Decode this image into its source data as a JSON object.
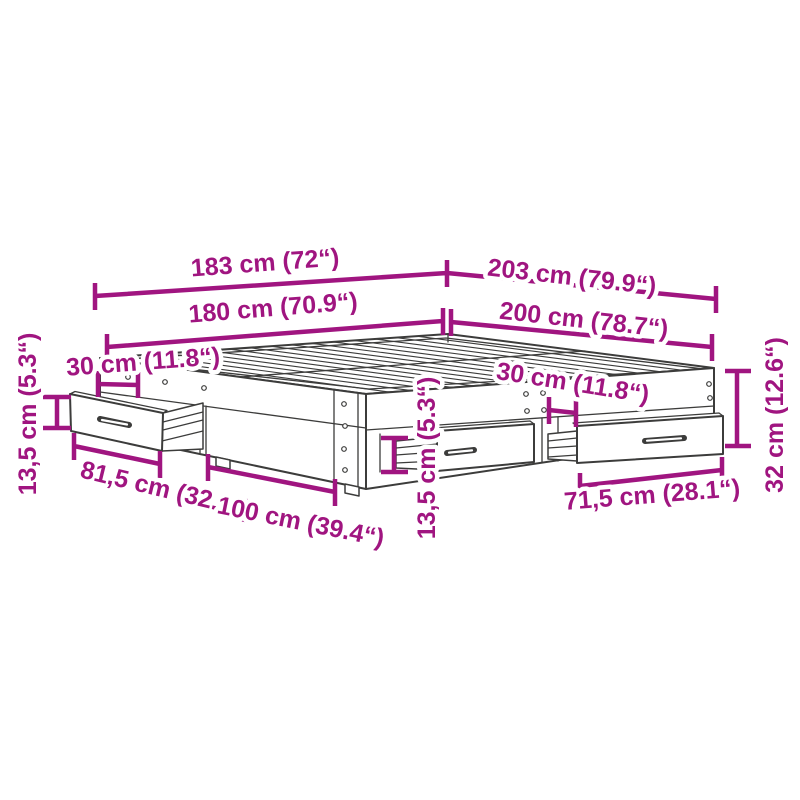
{
  "diagram": {
    "subject": "bed-frame-with-storage-drawers-dimension-diagram",
    "style": {
      "dimension_color": "#A01580",
      "drawing_color": "#3C3C3B",
      "background_color": "#FFFFFF"
    },
    "dimensions": [
      {
        "id": "outer-width",
        "text": "183 cm (72“)",
        "cm": "183",
        "inches": "72"
      },
      {
        "id": "outer-length",
        "text": "203 cm (79.9“)",
        "cm": "203",
        "inches": "79.9"
      },
      {
        "id": "inner-width",
        "text": "180 cm (70.9“)",
        "cm": "180",
        "inches": "70.9"
      },
      {
        "id": "inner-length",
        "text": "200 cm (78.7“)",
        "cm": "200",
        "inches": "78.7"
      },
      {
        "id": "left-drawer-offset",
        "text": "30 cm (11.8“)",
        "cm": "30",
        "inches": "11.8"
      },
      {
        "id": "left-drawer-height",
        "text": "13,5 cm (5.3“)",
        "cm": "13,5",
        "inches": "5.3"
      },
      {
        "id": "left-drawer-width",
        "text": "81,5 cm (32.1“)",
        "cm": "81,5",
        "inches": "32.1"
      },
      {
        "id": "front-drawer-width",
        "text": "100 cm (39.4“)",
        "cm": "100",
        "inches": "39.4"
      },
      {
        "id": "front-drawer-height",
        "text": "13,5 cm (5.3“)",
        "cm": "13,5",
        "inches": "5.3"
      },
      {
        "id": "right-drawer-offset",
        "text": "30 cm (11.8“)",
        "cm": "30",
        "inches": "11.8"
      },
      {
        "id": "right-drawer-width",
        "text": "71,5 cm (28.1“)",
        "cm": "71,5",
        "inches": "28.1"
      },
      {
        "id": "frame-height",
        "text": "32 cm (12.6“)",
        "cm": "32",
        "inches": "12.6"
      }
    ]
  }
}
